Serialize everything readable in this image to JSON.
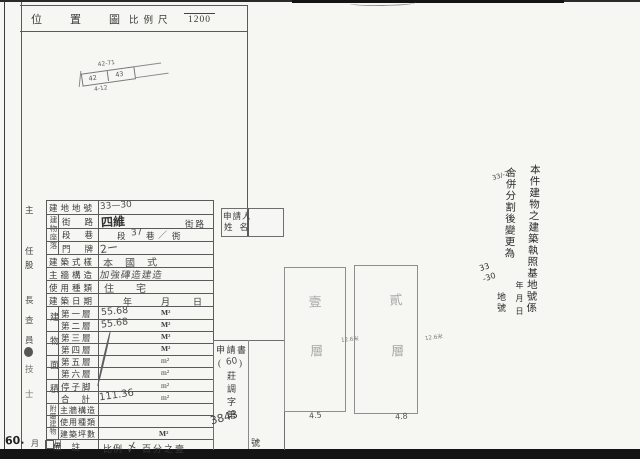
{
  "header": {
    "title": "位置圖",
    "scale_label": "比例尺",
    "scale_value": "1200"
  },
  "location_sketch": {
    "top_label": "42-71",
    "cell_left": "42",
    "cell_right": "43",
    "bottom_label": "4-12"
  },
  "left_margin": {
    "chars": [
      "主",
      "任",
      "股",
      "長",
      "查",
      "員",
      "技",
      "士"
    ],
    "bottom_year": "60.",
    "bottom_month": "月",
    "bottom_day": "日"
  },
  "form": {
    "lot_row": {
      "label": "建地地號",
      "value": "33—30"
    },
    "location_group": "建物座落",
    "street_row": {
      "label": "街路",
      "hand": "四維",
      "print": "街路"
    },
    "section_row": {
      "label": "段巷",
      "p1": "段",
      "h1": "37",
      "p2": "巷",
      "h2": "／",
      "p3": "衖"
    },
    "door_row": {
      "label": "門牌",
      "hand": "2ー"
    },
    "style_row": {
      "label": "建築式樣",
      "value": "本國式"
    },
    "wall_row": {
      "label": "主牆構造",
      "value": "加強磚造建造"
    },
    "use_row": {
      "label": "使用種類",
      "value": "住宅"
    },
    "date_row": {
      "label": "建築日期",
      "y": "年",
      "m": "月",
      "d": "日"
    },
    "area_group": "建物面積",
    "floors": [
      {
        "label": "第一層",
        "value": "55.68",
        "unit": "M²"
      },
      {
        "label": "第二層",
        "value": "55.68",
        "unit": "M²"
      },
      {
        "label": "第三層",
        "value": "",
        "unit": "M²"
      },
      {
        "label": "第四層",
        "value": "",
        "unit": "M²"
      },
      {
        "label": "第五層",
        "value": "",
        "unit": "m²"
      },
      {
        "label": "第六層",
        "value": "",
        "unit": "m²"
      },
      {
        "label": "停子脚",
        "value": "",
        "unit": "m²"
      },
      {
        "label": "合計",
        "value": "111.36",
        "unit": "m²"
      }
    ],
    "annex_group": "附屬建物",
    "annex_rows": [
      {
        "label": "主牆構造",
        "unit": ""
      },
      {
        "label": "使用種類",
        "unit": ""
      },
      {
        "label": "建築坪數",
        "unit": "M²"
      }
    ],
    "remark_row": {
      "label": "備註",
      "p1": "比例",
      "hand": "〆",
      "p2": "百分之壹"
    }
  },
  "applicant": {
    "line1": "申請人",
    "line2": "姓名"
  },
  "application": {
    "title": "申請書",
    "paren_open": "(",
    "year": "60",
    "paren_close": ")",
    "doc_chars": "莊調字第",
    "number": "3843",
    "suffix": "號"
  },
  "note": {
    "col1": "本件建物之建築執照基地號係",
    "col2": "合併分割後變更為",
    "small_lot": "33/-21",
    "dates": "年月日",
    "hand_lot": "33\n-30",
    "lot_suffix": "地號"
  },
  "floor_plans": {
    "left": {
      "label": "壹層",
      "width_dim": "4.5",
      "side_dim": "12.6米"
    },
    "right": {
      "label": "貳層",
      "width_dim": "4.8",
      "side_dim": "12.6米"
    }
  }
}
